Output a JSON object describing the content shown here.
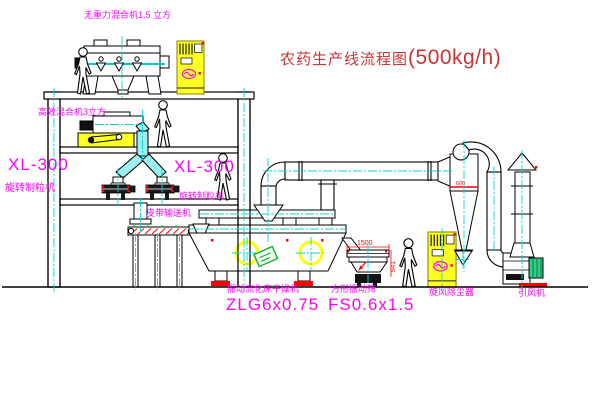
{
  "title": {
    "text_cn": "农药生产线流程图",
    "capacity": "(500kg/h)"
  },
  "equipment_labels": {
    "gravity_free_mixer": "无重力混合机1.5 立方",
    "mixer_3m3": "高效混合机3立方",
    "granulator_left": {
      "model": "XL-300",
      "name": "旋转制粒机"
    },
    "granulator_center": {
      "model": "XL-300",
      "name": "旋转制粒机"
    },
    "belt_conveyor": "皮带输送机",
    "fluid_bed_dryer": {
      "name": "振动流化床干燥机",
      "model": "ZLG6x0.75"
    },
    "vibrating_sieve": {
      "name": "方形振动筛",
      "model": "FS0.6x1.5"
    },
    "cyclone": "旋风除尘器",
    "induced_draft_fan": "引风机"
  },
  "dimensions": {
    "sieve_length": "1500",
    "sieve_height": "541",
    "cyclone_marker": "600"
  },
  "colors": {
    "label_magenta": "#ff00ff",
    "title_red": "#cc3333",
    "dim_red": "#ff0000",
    "machine_yellow": "#ffff00",
    "centerline_cyan": "#00d8d8",
    "accent_green": "#00aa22"
  }
}
